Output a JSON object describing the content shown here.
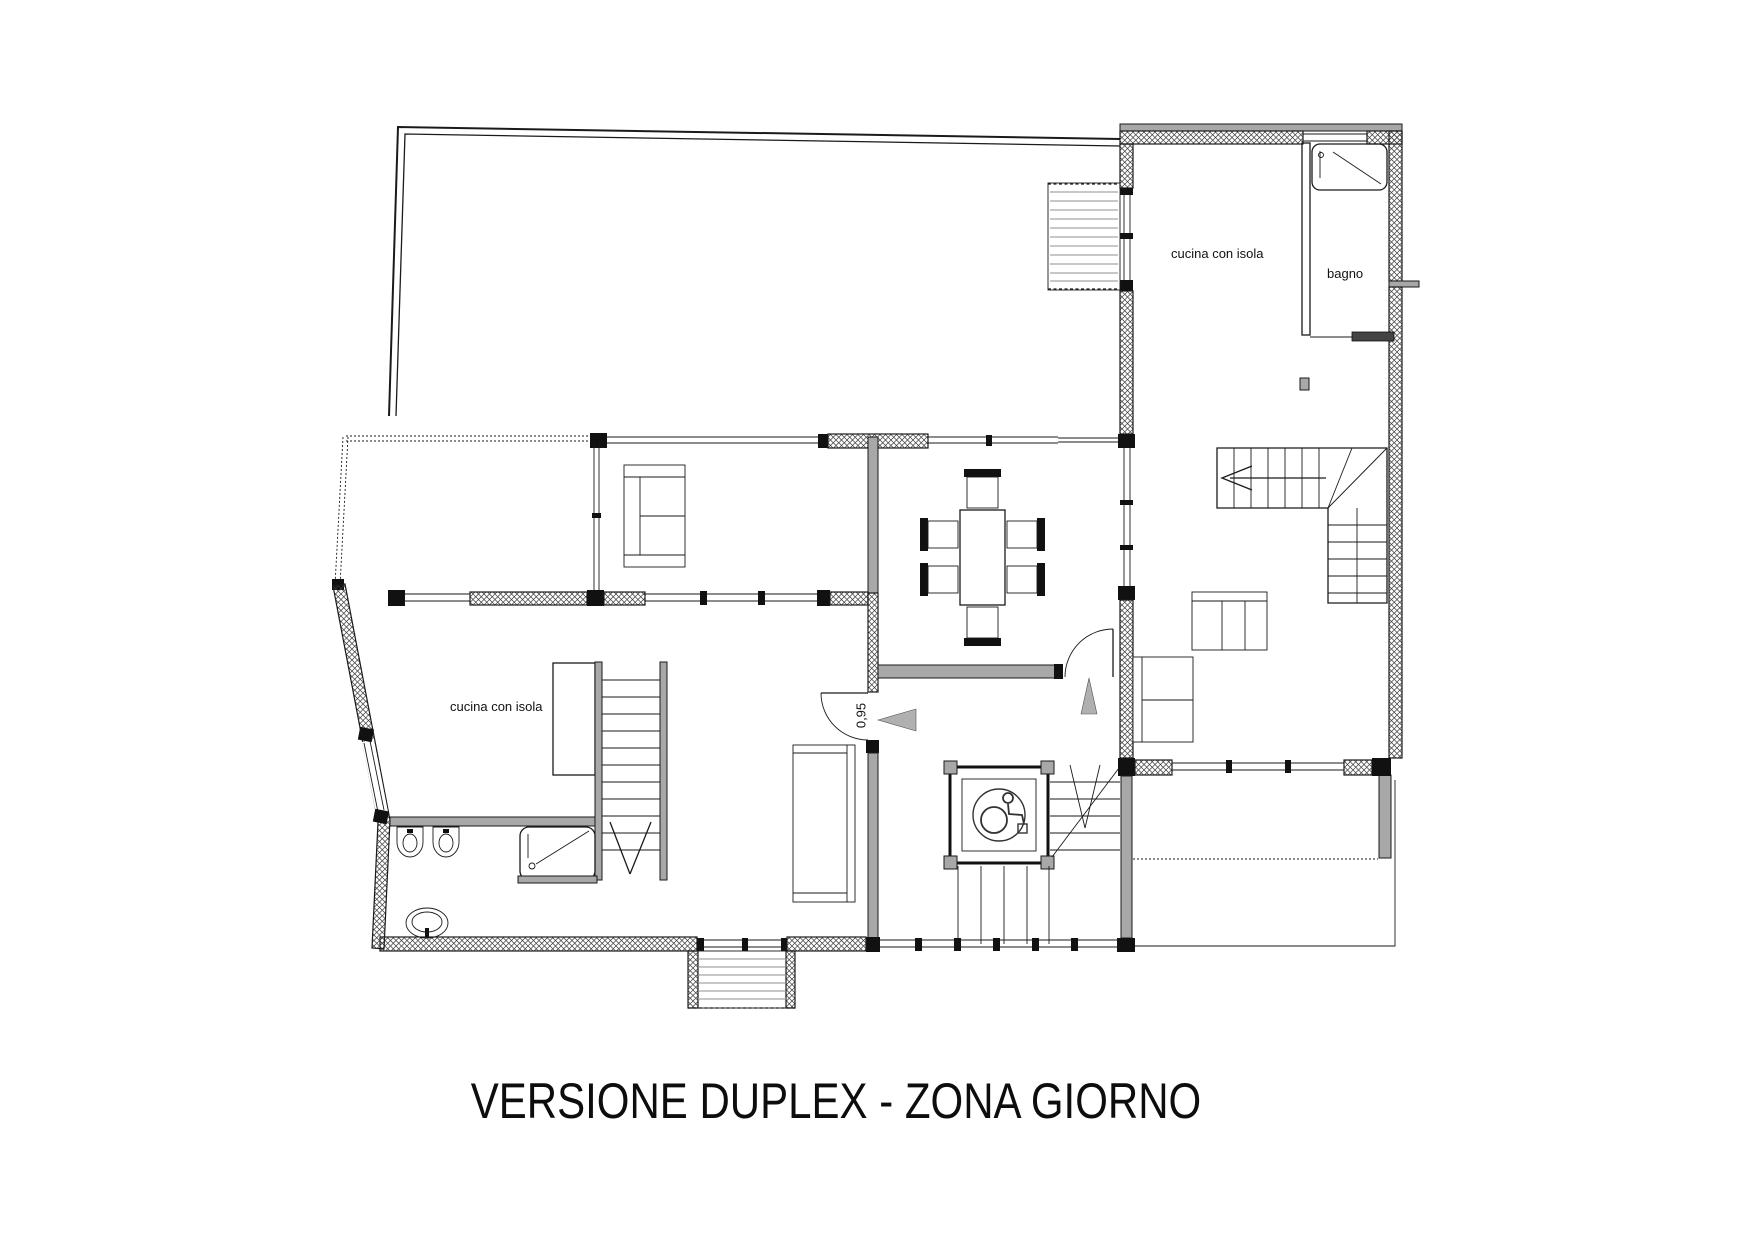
{
  "title": "VERSIONE DUPLEX - ZONA GIORNO",
  "rooms": {
    "kitchen_left": {
      "label": "cucina con isola"
    },
    "kitchen_right": {
      "label": "cucina con isola"
    },
    "bathroom": {
      "label": "bagno"
    }
  },
  "dimensions": {
    "door_width": "0,95"
  },
  "icons": {
    "accessibility": "wheelchair-icon"
  },
  "colors": {
    "line": "#1a1a1a",
    "wall_gray": "#a8a8a8",
    "arrow_gray": "#b0b0b0",
    "background": "#ffffff"
  }
}
